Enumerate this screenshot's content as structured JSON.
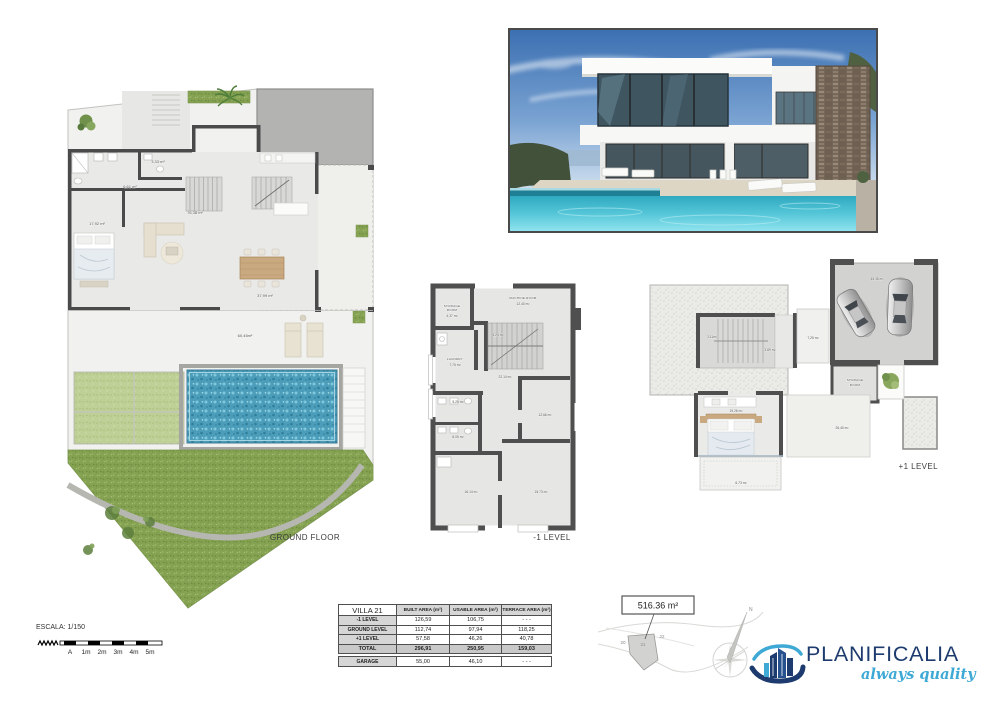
{
  "sheet": {
    "ground_floor_label": "GROUND FLOOR",
    "minus1_label": "-1 LEVEL",
    "plus1_label": "+1 LEVEL"
  },
  "ground_floor": {
    "areas": {
      "wc": "3,33 m²",
      "hall": "6,61 m²",
      "living": "76,38 m²",
      "bedroom": "17,92 m²",
      "terrace": "37,99 m²",
      "garden_terrace": "60,45m²"
    }
  },
  "minus1": {
    "storage_line1": "STORAGE",
    "storage_line2": "ROOM",
    "storage_area": "4,37 m²",
    "machine_name": "MACHINE ROOM",
    "machine_area": "12,40 m²",
    "stairs_area": "4,24 m²",
    "laundry_name": "LAUNDRY",
    "laundry_area": "7,75 m²",
    "hall_area": "22,14 m²",
    "bath1_area": "5,25 m²",
    "bath2_area": "6,05 m²",
    "bedroom_right_area": "12,66 m²",
    "bedroom_left_area": "16,14 m²",
    "bedroom_bottom_area": "15,73 m²"
  },
  "plus1": {
    "stairs_area": "3,11m²",
    "hall_area": "3,89 m²",
    "terrace_small_area": "7,25 m²",
    "garage_area": "45,35 m²",
    "storage_line1": "STORAGE",
    "storage_line2": "ROOM",
    "bedroom_area": "19,26 m²",
    "terrace_area": "26,40 m²",
    "balcony_area": "6,73 m²"
  },
  "table": {
    "header": {
      "col0": "VILLA 21",
      "col1": "BUILT AREA (m²)",
      "col2": "USABLE AREA (m²)",
      "col3": "TERRACE AREA (m²)"
    },
    "rows": [
      {
        "label": "-1 LEVEL",
        "built": "126,59",
        "usable": "106,75",
        "terrace": "- - -"
      },
      {
        "label": "GROUND LEVEL",
        "built": "112,74",
        "usable": "97,94",
        "terrace": "118,25"
      },
      {
        "label": "+1 LEVEL",
        "built": "57,58",
        "usable": "46,26",
        "terrace": "40,78"
      },
      {
        "label": "TOTAL",
        "built": "296,91",
        "usable": "250,95",
        "terrace": "159,03"
      }
    ],
    "garage": {
      "label": "GARAGE",
      "built": "55,00",
      "usable": "46,10",
      "terrace": "- - -"
    }
  },
  "scale_bar": {
    "label": "ESCALA: 1/150",
    "ticks": [
      "A",
      "1m",
      "2m",
      "3m",
      "4m",
      "5m"
    ]
  },
  "site_plan": {
    "area_label": "516.36 m²",
    "plot_left": "20",
    "plot_center": "21",
    "plot_right": "22"
  },
  "compass": {
    "north_label": "N"
  },
  "logo": {
    "brand": "PLANIFICALIA",
    "tagline": "always quality",
    "navy": "#1d3b6e",
    "light_blue": "#3fa9d6"
  }
}
